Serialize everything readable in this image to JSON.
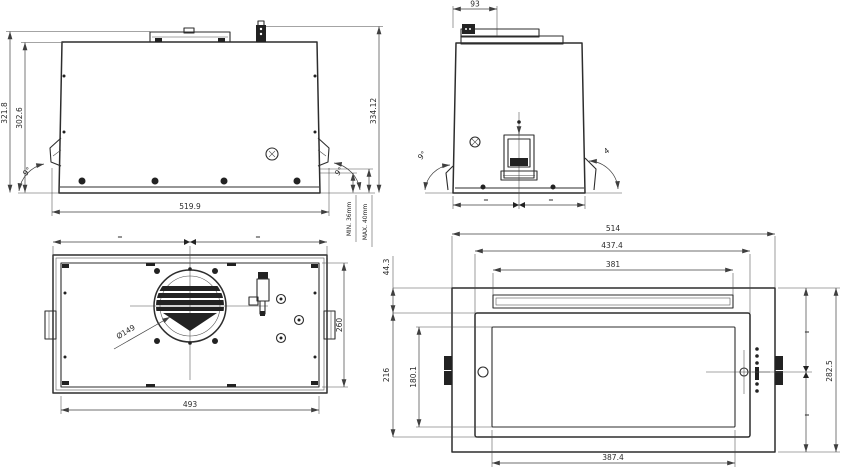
{
  "drawing": {
    "background": "#ffffff",
    "line_color": "#2d2d2d",
    "views": {
      "front": {
        "dim_height_outer": "321.8",
        "dim_height_inner": "302.6",
        "dim_height_total": "334.12",
        "dim_width": "519.9",
        "angle_left": "9°",
        "angle_right": "9°",
        "gap_min": "MIN. 36mm",
        "gap_max": "MAX. 40mm"
      },
      "side": {
        "dim_duct": "93",
        "angle_left": "9°",
        "angle_right": "4",
        "equal": "="
      },
      "top": {
        "dim_fan": "Ø149",
        "dim_depth": "260",
        "dim_width": "493",
        "equal": "="
      },
      "bottom": {
        "dim_width_total": "514",
        "dim_width_frame": "437.4",
        "dim_width_slot": "381",
        "dim_offset_top": "44.3",
        "dim_panel_height": "216",
        "dim_glass_height": "180.1",
        "dim_depth_total": "282.5",
        "dim_width_panel": "387.4",
        "equal": "="
      }
    }
  }
}
